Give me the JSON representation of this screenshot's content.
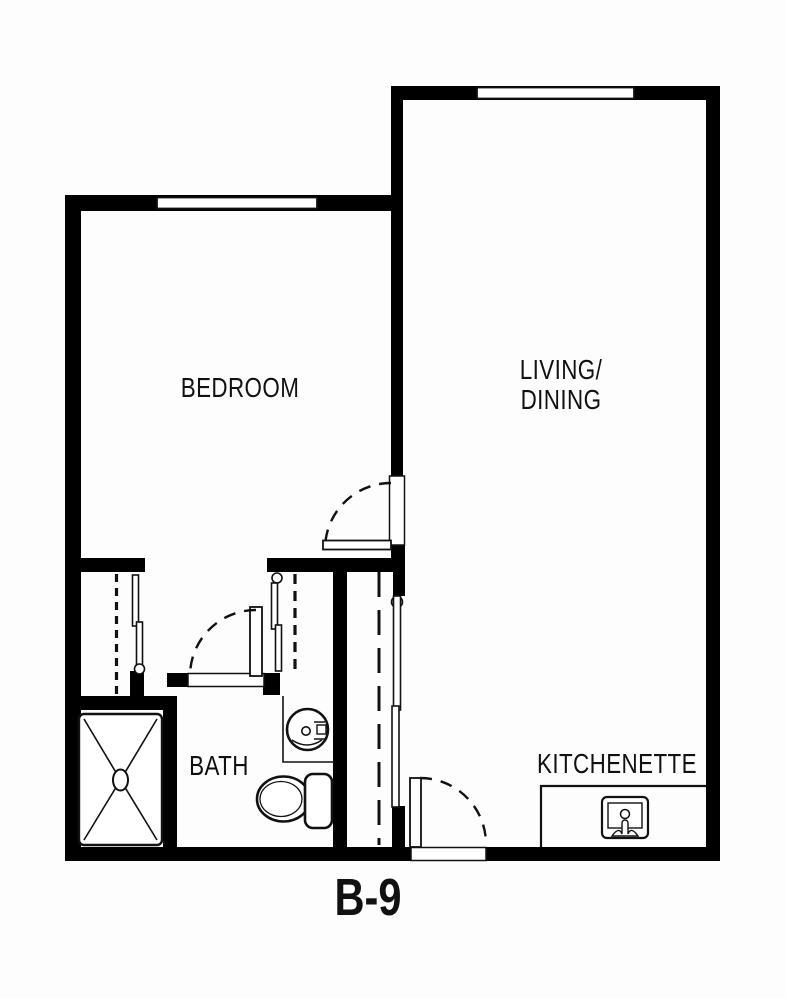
{
  "unit": {
    "label": "B-9"
  },
  "rooms": {
    "bedroom": {
      "label": "BEDROOM"
    },
    "living_dining": {
      "line1": "LIVING/",
      "line2": "DINING"
    },
    "bath": {
      "label": "BATH"
    },
    "kitchenette": {
      "label": "KITCHENETTE"
    }
  },
  "symbols": {
    "windows": [
      "bedroom-window",
      "living-window"
    ],
    "doors": [
      "bedroom-door-swing",
      "bath-door-swing",
      "entry-door-swing"
    ],
    "closets": [
      "bedroom-closet-bifold",
      "vestibule-closet-bifold",
      "wardrobe-sliding-panels"
    ],
    "closet_rods": [
      "bedroom-closet-rod",
      "vestibule-closet-rod",
      "wardrobe-closet-rod"
    ],
    "fixtures": [
      "shower-stall",
      "bath-sink",
      "toilet",
      "kitchen-counter",
      "kitchen-sink"
    ]
  },
  "colors": {
    "wall": "#000000",
    "line": "#111111",
    "text": "#111111",
    "background": "#fdfdfd"
  }
}
